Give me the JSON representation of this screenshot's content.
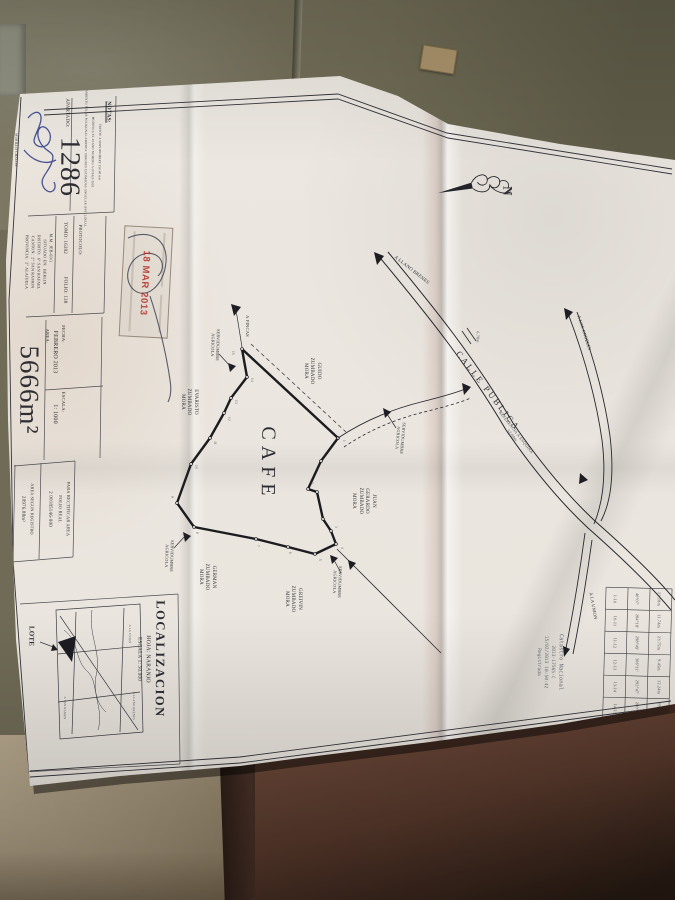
{
  "header": {
    "notas_title": "NOTAS:",
    "notas_lines": [
      "FRENTE A SERVIDUMBRE 250.48 mts",
      "MODIFICA EL PLANO NUMERO A-970423-1991",
      "LEVANTAMIENTO POLAR POLIGONAL ABIERTA. ERRORES ESTIMADOS ANGULAR (PST) LINEAL"
    ],
    "apartado_label": "APARTADO:",
    "apartado_value": "1286",
    "surveyor_name": "MURILLO CHACON",
    "surveyor_title": "AGRIMENSOR ASOCIADO A.A.-123",
    "protocolo_label": "PROTOCOLO:",
    "tomo": "TOMO: 16392",
    "folio": "FOLIO: 138",
    "file_ref": "M.M. JEB-03/1",
    "situado_lines": [
      "SITUADO EN:  BERLIN",
      "DISTRITO:  6° SAN RAFAEL",
      "CANTON:  2° SAN RAMON",
      "PROVINCIA:  2° ALAJUELA"
    ],
    "fecha_label": "FECHA:",
    "fecha_value": "FEBRERO 2013",
    "escala_label": "ESCALA:",
    "escala_value": "1: 1000",
    "area_label": "AREA:",
    "area_value": "5666m²",
    "rectificar_lines": [
      "PARA RECTIFICAR AREA",
      "FOLIO REAL",
      "2 00185146-000"
    ],
    "registro_label": "AREA SEGUN REGISTRO",
    "registro_value": "20976.88m²",
    "stamp_date": "18 MAR 2013"
  },
  "localizacion": {
    "title": "LOCALIZACION",
    "hoja": "HOJA: NARANJO",
    "escala": "ESCALA 1: 50.000",
    "lote": "LOTE",
    "inset_labels": [
      {
        "t": "A SAN RAMON",
        "x": 64,
        "y": 708
      },
      {
        "t": "A LA UNION",
        "x": 129,
        "y": 634
      },
      {
        "t": "A LLANO BRENES",
        "x": 133,
        "y": 706
      }
    ]
  },
  "map": {
    "cafe": "CAFE",
    "calle_publica": "CALLE PUBLICA",
    "north": "N",
    "cross_note": "6.78m",
    "ref_note": "REFERENCIA A ESQUINA\n52.04m",
    "labels": [
      {
        "t": "GUIDO\nZUMBADO\nMORA",
        "x": 311,
        "y": 371,
        "r": 90,
        "fs": 5
      },
      {
        "t": "EVARISTO\nZUMBADO\nMORA",
        "x": 188,
        "y": 402,
        "r": 90,
        "fs": 5
      },
      {
        "t": "JUAN\nGERARDO\nZUMBADO\nMORA",
        "x": 363,
        "y": 501,
        "r": 90,
        "fs": 5
      },
      {
        "t": "GERMAN\nZUMBADO\nMORA",
        "x": 206,
        "y": 577,
        "r": 90,
        "fs": 5
      },
      {
        "t": "GREIVIN\nZUMBADO\nMORA",
        "x": 292,
        "y": 599,
        "r": 90,
        "fs": 5
      },
      {
        "t": "SERVIDUMBRE\nAGRICOLA",
        "x": 215,
        "y": 345,
        "r": 92,
        "fs": 4.2
      },
      {
        "t": "SERVIDUMBRE\nAGRICOLA",
        "x": 169,
        "y": 556,
        "r": 92,
        "fs": 4.2
      },
      {
        "t": "SERVIDUMBRE\nAGRICOLA",
        "x": 400,
        "y": 438,
        "r": 95,
        "fs": 4.2
      },
      {
        "t": "SERVIDUMBRE\nAGRICOLA",
        "x": 337,
        "y": 582,
        "r": 92,
        "fs": 4.2
      },
      {
        "t": "A FINCAS",
        "x": 247,
        "y": 326,
        "r": 90,
        "fs": 4.5
      },
      {
        "t": "A LLANO BRENES",
        "x": 411,
        "y": 271,
        "r": 38,
        "fs": 4.8
      },
      {
        "t": "A LOS ANGELES",
        "x": 584,
        "y": 333,
        "r": 72,
        "fs": 4.5
      },
      {
        "t": "A LA UNION",
        "x": 593,
        "y": 606,
        "r": 80,
        "fs": 4.5
      }
    ],
    "stations": [
      {
        "t": "15",
        "x": 233,
        "y": 353
      },
      {
        "t": "14",
        "x": 252,
        "y": 380
      },
      {
        "t": "13",
        "x": 236,
        "y": 402
      },
      {
        "t": "12",
        "x": 229,
        "y": 419
      },
      {
        "t": "11",
        "x": 215,
        "y": 443
      },
      {
        "t": "10",
        "x": 196,
        "y": 467
      },
      {
        "t": "9",
        "x": 172,
        "y": 497
      },
      {
        "t": "8",
        "x": 197,
        "y": 533
      },
      {
        "t": "7",
        "x": 258,
        "y": 546
      },
      {
        "t": "6",
        "x": 290,
        "y": 553
      },
      {
        "t": "5",
        "x": 320,
        "y": 560
      },
      {
        "t": "4",
        "x": 342,
        "y": 548
      },
      {
        "t": "3",
        "x": 336,
        "y": 527
      },
      {
        "t": "2",
        "x": 312,
        "y": 483
      },
      {
        "t": "1",
        "x": 344,
        "y": 441
      }
    ]
  },
  "derrotero": {
    "rows": [
      [
        "1-10",
        "46°07'",
        "22.18m"
      ],
      [
        "10-11",
        "284°18'",
        "11.74m"
      ],
      [
        "11-12",
        "298°49'",
        "23.75m"
      ],
      [
        "12-13",
        "306°11'",
        "9.45m"
      ],
      [
        "13-14",
        "292°47'",
        "12.24m"
      ],
      [
        "14-15",
        "280°12'",
        "19.06m"
      ],
      [
        "15-1",
        "132°50'",
        "131.26m"
      ]
    ]
  },
  "digital_stamp_lines": [
    "Catastro Nacional",
    "2013-17565-C",
    "15/02/2013 10:50:42",
    "Registrada"
  ]
}
